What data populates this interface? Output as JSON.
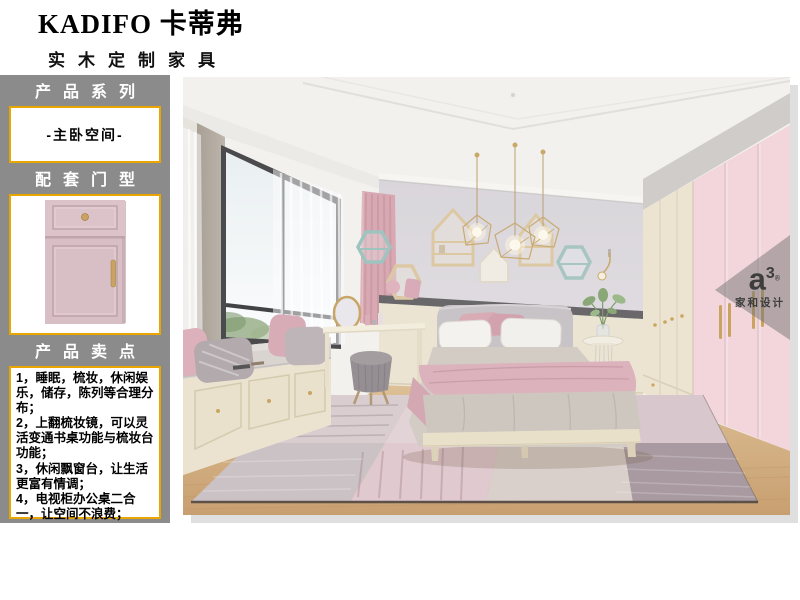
{
  "brand": {
    "name": "KADIFO 卡蒂弗",
    "tagline": "实木定制家具"
  },
  "colors": {
    "accent_gold": "#eaa600",
    "panel_gray": "#8b8b8b",
    "door_pink": "#d8bfc5"
  },
  "sidebar": {
    "series": {
      "title": "产品系列",
      "value": "-主卧空间-"
    },
    "door": {
      "title": "配套门型"
    },
    "selling": {
      "title": "产品卖点",
      "points": [
        "1，睡眠，梳妆，休闲娱乐，储存，陈列等合理分布；",
        "2，上翻梳妆镜，可以灵活变通书桌功能与梳妆台功能；",
        "3，休闲飘窗台，让生活更富有情调；",
        "4，电视柜办公桌二合一，让空间不浪费；"
      ]
    }
  },
  "photo": {
    "watermark": {
      "logo": "a",
      "sup": "3",
      "reg": "®",
      "name": "家和设计"
    }
  }
}
